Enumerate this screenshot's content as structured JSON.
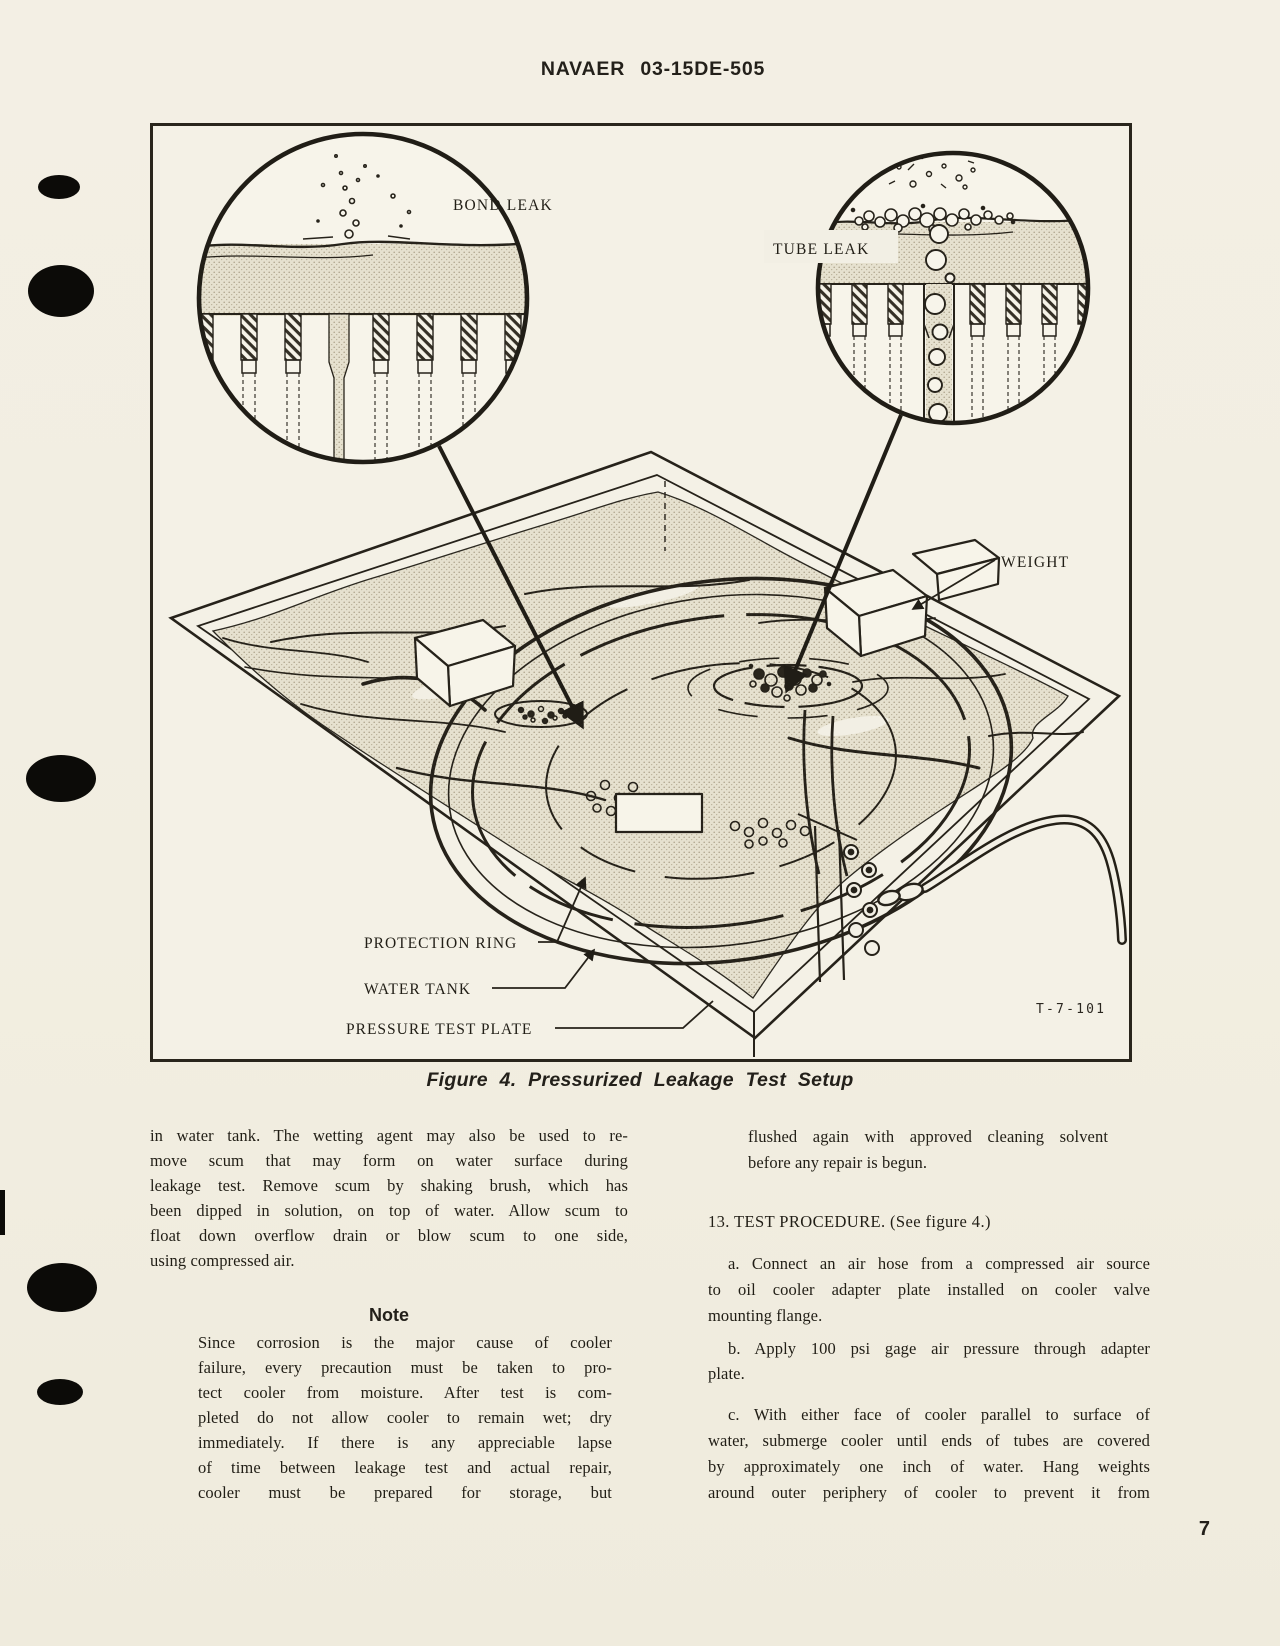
{
  "page": {
    "header": "NAVAER 03-15DE-505",
    "page_number": "7",
    "background_color": "#f2eee1",
    "ink_color": "#211e16"
  },
  "figure": {
    "caption": "Figure 4.  Pressurized Leakage Test Setup",
    "drawing_number": "T-7-101",
    "labels": {
      "bond_leak": "BOND LEAK",
      "tube_leak": "TUBE LEAK",
      "weight": "WEIGHT",
      "protection_ring": "PROTECTION RING",
      "water_tank": "WATER TANK",
      "pressure_test_plate": "PRESSURE TEST PLATE"
    },
    "line_color": "#26221a",
    "water_color": "#e6e1cf"
  },
  "left_column": {
    "para1_lines": [
      "in water tank. The wetting agent may also be used to re-",
      "move scum that may form on water surface during",
      "leakage test. Remove scum by shaking brush, which has",
      "been dipped in solution, on top of water. Allow scum to",
      "float down overflow drain or blow scum to one side,",
      "using compressed air."
    ],
    "note_heading": "Note",
    "note_lines": [
      "Since corrosion is the major cause of cooler",
      "failure, every precaution must be taken to pro-",
      "tect cooler from moisture. After test is com-",
      "pleted do not allow cooler to remain wet; dry",
      "immediately. If there is any appreciable lapse",
      "of time between leakage test and actual repair,",
      "cooler must be prepared for storage, but"
    ]
  },
  "right_column": {
    "note_cont_lines": [
      "flushed again with approved cleaning solvent",
      "before any repair is begun."
    ],
    "heading_13": "13. TEST PROCEDURE. (See figure 4.)",
    "para_a_lines": [
      "a. Connect an air hose from a compressed air source",
      "to oil cooler adapter plate installed on cooler valve",
      "mounting flange."
    ],
    "para_b_lines": [
      "b. Apply 100 psi gage air pressure through adapter",
      "plate."
    ],
    "para_c_lines": [
      "c. With either face of cooler parallel to surface of",
      "water, submerge cooler until ends of tubes are covered",
      "by approximately one inch of water. Hang weights",
      "around outer periphery of cooler to prevent it from"
    ]
  }
}
